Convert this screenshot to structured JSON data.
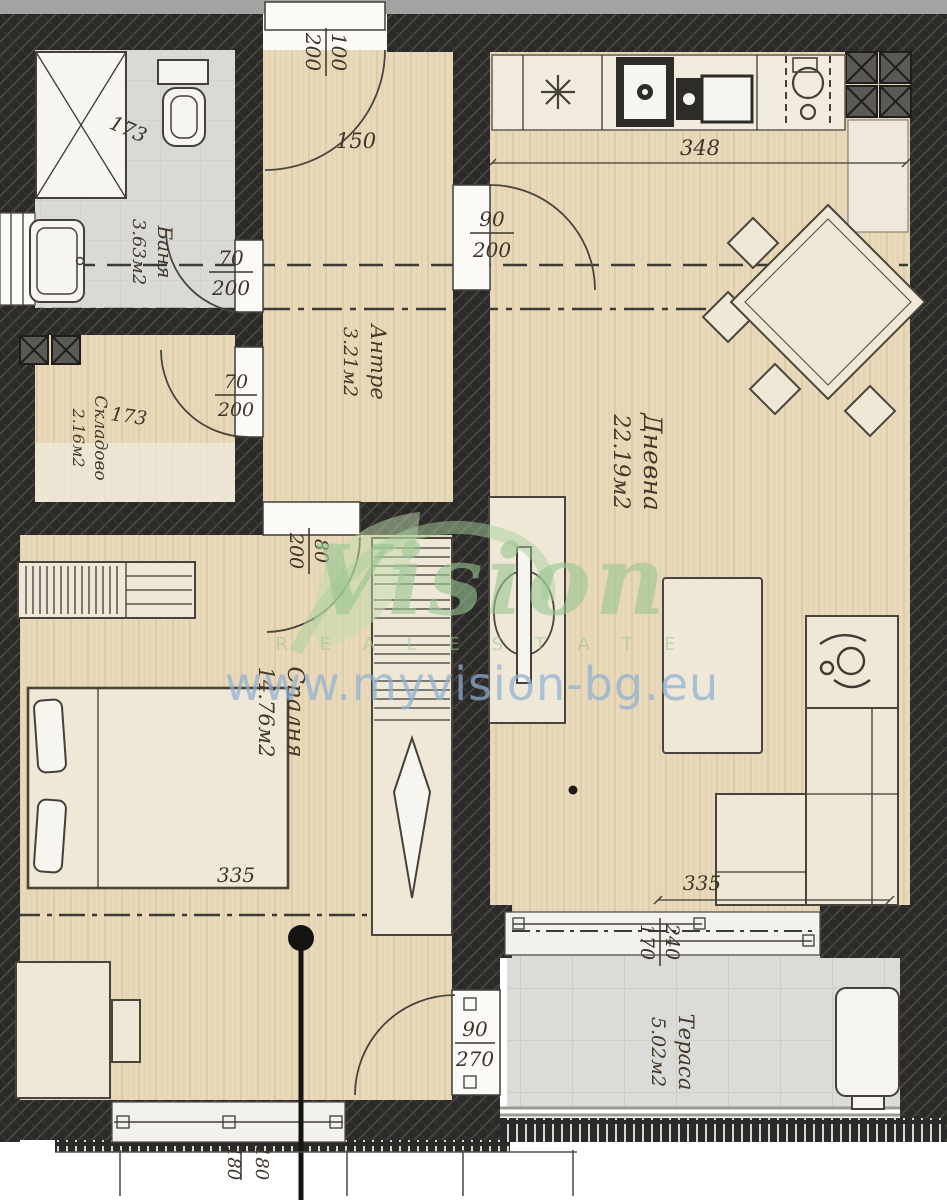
{
  "watermark": {
    "brand": "Vision",
    "tagline": "R E A L   E S T A T E",
    "url": "www.myvision-bg.eu",
    "green": "#98c693",
    "blue": "#8fb0d4"
  },
  "rooms": {
    "bath": {
      "name": "Баня",
      "area": "3.63м2"
    },
    "storage": {
      "name": "Складово",
      "area": "2.16м2"
    },
    "hall": {
      "name": "Антре",
      "area": "3.21м2"
    },
    "living": {
      "name": "Дневна",
      "area": "22.19м2"
    },
    "bedroom": {
      "name": "Спалня",
      "area": "14.76м2"
    },
    "terrace": {
      "name": "Тераса",
      "area": "5.02м2"
    }
  },
  "dims": {
    "entry_door": {
      "w": "100",
      "h": "200"
    },
    "entry_swing": "150",
    "bath_door": {
      "w": "70",
      "h": "200"
    },
    "storage_door": {
      "w": "70",
      "h": "200"
    },
    "living_door": {
      "w": "90",
      "h": "200"
    },
    "bedroom_door": {
      "w": "80",
      "h": "200"
    },
    "terrace_door": {
      "w": "90",
      "h": "270"
    },
    "shower_width": "173",
    "storage_width": "173",
    "kitchen_length": "348",
    "bed_length": "335",
    "sofa_length": "335",
    "terrace_window": {
      "w": "240",
      "h": "170"
    },
    "bedroom_window": {
      "w": "180",
      "h": "180"
    }
  },
  "palette": {
    "wall": "#2b2a28",
    "wood": "#e9d9bb",
    "tile": "#dbdbd7",
    "label": "#45392a"
  }
}
